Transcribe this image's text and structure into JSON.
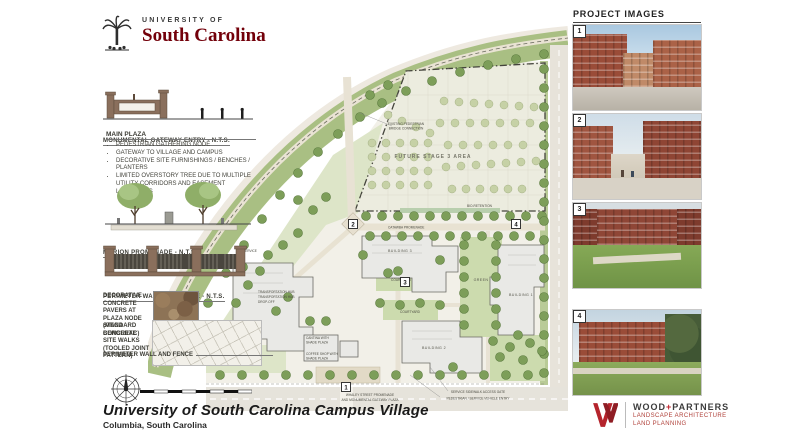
{
  "logo": {
    "top": "UNIVERSITY OF",
    "name": "South Carolina"
  },
  "left_panel": {
    "gateway_caption": "MONUMENTAL GATEWAY ENTRY - N.T.S.",
    "main_plaza": {
      "heading": "MAIN PLAZA",
      "bullets": [
        "PEDESTRIAN GATHERING NODE",
        "GATEWAY TO VILLAGE AND CAMPUS",
        "DECORATIVE SITE FURNISHINGS / BENCHES / PLANTERS",
        "LIMITED OVERSTORY TREE DUE TO MULTIPLE UTILITY CORRIDORS AND EASEMENT LIMITATIONS"
      ]
    },
    "promenade_caption": "MARION PROMENADE - N.T.S.",
    "wall_caption": "PERIMETER WALL AND FENCE - N.T.S.",
    "pavers_label": "DECORATIVE CONCRETE PAVERS AT PLAZA NODE (MEGA BERGERAC)",
    "walks_label": "STANDARD CONCRETE SITE WALKS (TOOLED JOINT PATTERN)",
    "perimeter_label": "PERIMETER WALL AND FENCE"
  },
  "plan": {
    "labels": {
      "bridge1": "EXISTING PEDESTRIAN",
      "bridge2": "BRIDGE CONNECTION",
      "future_stage": "FUTURE STAGE 3 AREA",
      "catawba": "CATAWBA PROMENADE",
      "building1": "BUILDING 1",
      "building2": "BUILDING 2",
      "building3": "BUILDING 3",
      "courtyard1": "COURTYARD",
      "courtyard2": "COURTYARD",
      "green": "GREEN",
      "service": "SERVICE",
      "bioretention": "BIO-RETENTION",
      "hub1": "TRANSPORTATION HUB",
      "hub2": "TRANSPORTATION HUB",
      "hub3": "DROP-OFF",
      "cantina1": "CANTINA WITH",
      "cantina2": "SHADE PLAZA",
      "coffee1": "COFFEE SHOP WITH",
      "coffee2": "SHADE PLAZA",
      "whaley1": "WHALEY STREET PROMENADE",
      "whaley2": "AND MONUMENTAL GATEWAY PLAZA",
      "gate1": "SERVICE SIDEWALK ACCESS GATE",
      "gate2": "PEDESTRIAN / SERVICE VEHICLE ENTRY"
    },
    "markers": [
      "1",
      "2",
      "3",
      "4"
    ]
  },
  "right_panel": {
    "heading": "PROJECT IMAGES",
    "images": [
      {
        "number": "1"
      },
      {
        "number": "2"
      },
      {
        "number": "3"
      },
      {
        "number": "4"
      }
    ]
  },
  "titleblock": {
    "title": "University of South Carolina Campus Village",
    "subtitle": "Columbia, South Carolina"
  },
  "firm": {
    "wood": "WOOD",
    "plus": "+",
    "partners": "PARTNERS",
    "tag1": "LANDSCAPE ARCHITECTURE",
    "tag2": "LAND PLANNING"
  },
  "colors": {
    "garnet": "#73000a",
    "firm_red": "#c0222c",
    "plan_green": "#7d9e59"
  }
}
